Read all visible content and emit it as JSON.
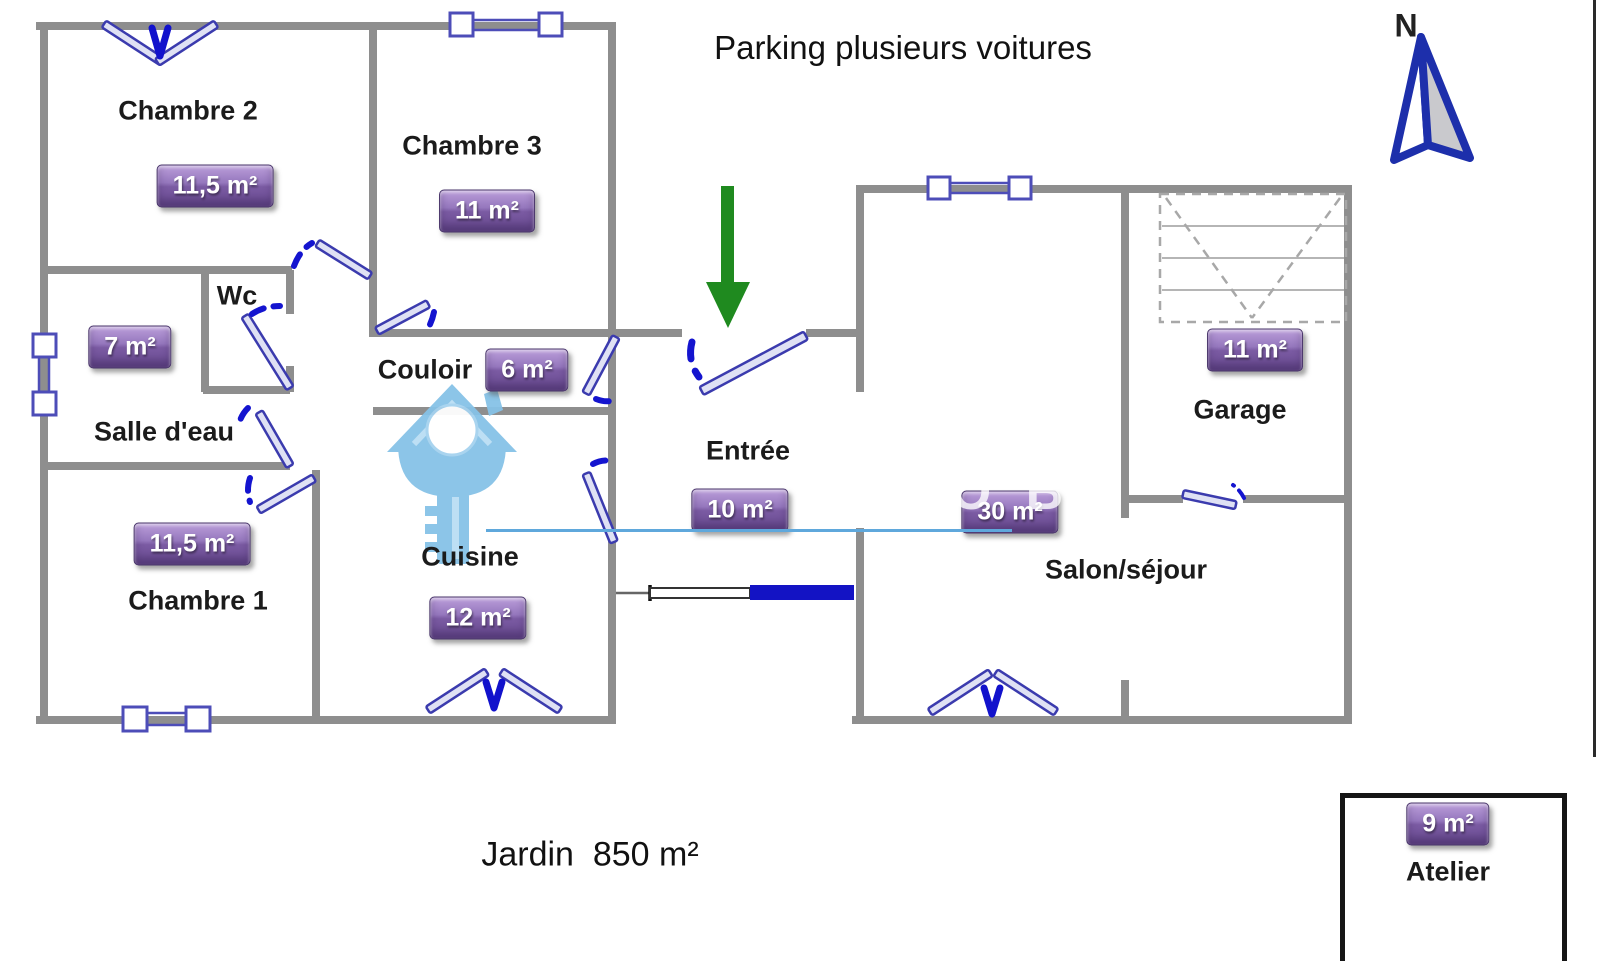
{
  "annotations": {
    "parking": "Parking plusieurs voitures",
    "jardin": "Jardin  850 m²",
    "north_label": "N"
  },
  "rooms": [
    {
      "name": "Chambre 2",
      "area": "11,5 m²"
    },
    {
      "name": "Chambre 3",
      "area": "11 m²"
    },
    {
      "name": "Wc",
      "area": ""
    },
    {
      "name": "Salle d'eau",
      "area": "7 m²"
    },
    {
      "name": "Couloir",
      "area": "6 m²"
    },
    {
      "name": "Chambre 1",
      "area": "11,5 m²"
    },
    {
      "name": "Cuisine",
      "area": "12 m²"
    },
    {
      "name": "Entrée",
      "area": "10 m²"
    },
    {
      "name": "Salon/séjour",
      "area": "30 m²"
    },
    {
      "name": "Garage",
      "area": "11 m²"
    },
    {
      "name": "Atelier",
      "area": "9 m²"
    }
  ],
  "watermark": {
    "fragments": [
      "O B",
      "DE F"
    ]
  },
  "icons": {
    "north_arrow": "compass-north-arrow",
    "entrance_arrow": "green-down-arrow",
    "key": "house-key-watermark"
  },
  "colors": {
    "wall": "#8e8e8e",
    "door_leaf_fill": "#dfe1f4",
    "door_leaf_stroke": "#3b3bae",
    "door_swing_dash": "#1414cf",
    "window_stroke": "#4d4db8",
    "entrance_arrow_green": "#1f8a1f",
    "north_arrow_blue": "#1d2fab",
    "key_watermark_blue": "#86c2e7",
    "sliding_door_blue": "#1313c4",
    "watermark_line_blue": "#5fa8dc",
    "badge_purple": "#7a5aa2",
    "badge_text": "#ffffff",
    "label_text": "#1b1b1b"
  }
}
